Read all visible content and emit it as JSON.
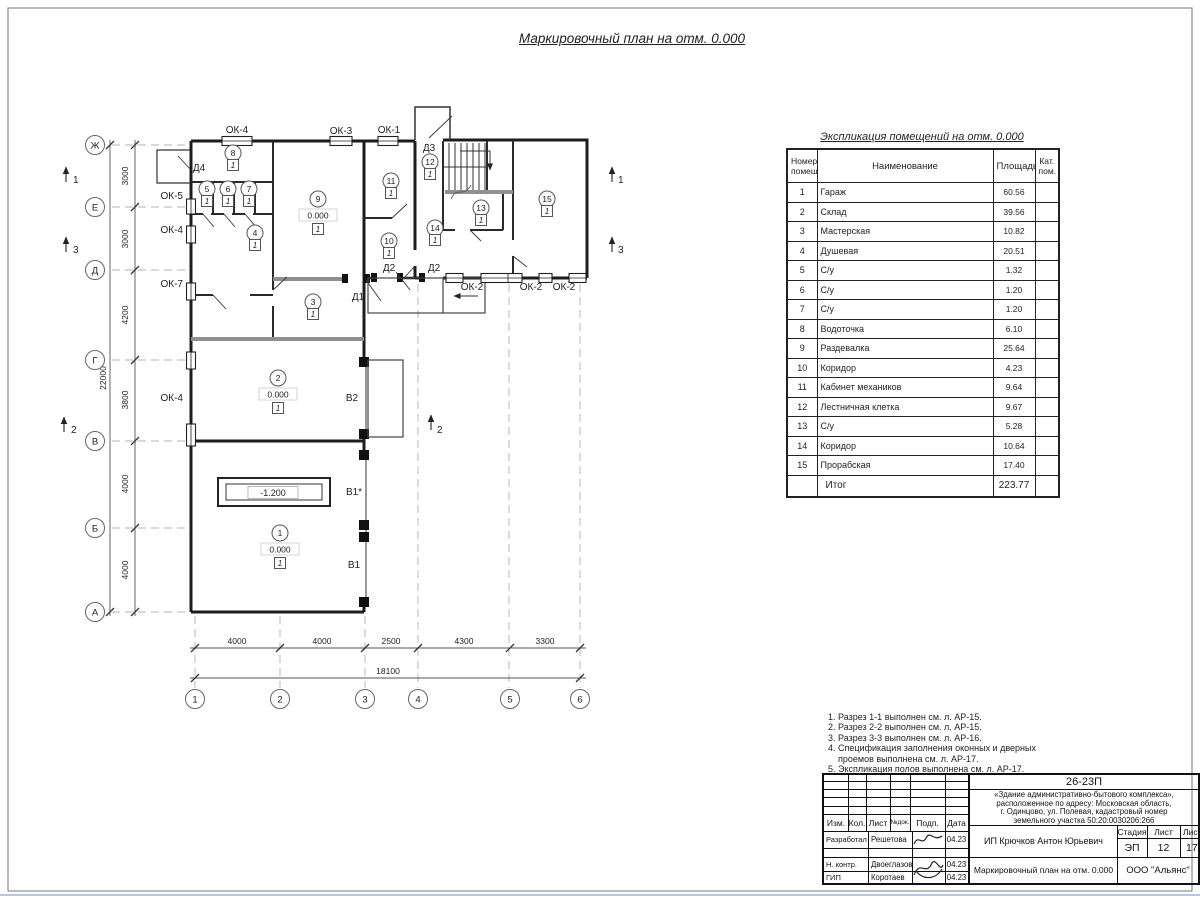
{
  "page": {
    "plan_title": "Маркировочный план на отм. 0.000",
    "schedule_title": "Экспликация помещений на отм. 0.000",
    "notes": "1. Разрез 1-1 выполнен см. л. АР-15.\n2. Разрез 2-2 выполнен см. л. АР-15.\n3. Разрез 3-3 выполнен см. л. АР-16.\n4. Спецификация заполнения оконных и дверных\n    проемов выполнена см. л. АР-17.\n5. Экспликация полов выполнена см. л. АР-17."
  },
  "schedule": {
    "h_num1": "Номер",
    "h_num2": "помещ.",
    "h_name": "Наименование",
    "h_area": "Площадь",
    "h_cat1": "Кат.",
    "h_cat2": "пом.",
    "rows": [
      {
        "n": "1",
        "name": "Гараж",
        "area": "60.56"
      },
      {
        "n": "2",
        "name": "Склад",
        "area": "39.56"
      },
      {
        "n": "3",
        "name": "Мастерская",
        "area": "10.82"
      },
      {
        "n": "4",
        "name": "Душевая",
        "area": "20.51"
      },
      {
        "n": "5",
        "name": "С/у",
        "area": "1.32"
      },
      {
        "n": "6",
        "name": "С/у",
        "area": "1.20"
      },
      {
        "n": "7",
        "name": "С/у",
        "area": "1.20"
      },
      {
        "n": "8",
        "name": "Водоточка",
        "area": "6.10"
      },
      {
        "n": "9",
        "name": "Раздевалка",
        "area": "25.64"
      },
      {
        "n": "10",
        "name": "Коридор",
        "area": "4.23"
      },
      {
        "n": "11",
        "name": "Кабинет механиков",
        "area": "9.64"
      },
      {
        "n": "12",
        "name": "Лестничная клетка",
        "area": "9.67"
      },
      {
        "n": "13",
        "name": "С/у",
        "area": "5.28"
      },
      {
        "n": "14",
        "name": "Коридор",
        "area": "10.64"
      },
      {
        "n": "15",
        "name": "Прорабская",
        "area": "17.40"
      }
    ],
    "total_label": "Итог",
    "total_area": "223.77"
  },
  "axes": {
    "h1": "Ж",
    "h2": "Е",
    "h3": "Д",
    "h4": "Г",
    "h5": "В",
    "h6": "Б",
    "h7": "А",
    "v1": "1",
    "v2": "2",
    "v3": "3",
    "v4": "4",
    "v5": "5",
    "v6": "6"
  },
  "dims": {
    "l1": "3000",
    "l2": "3000",
    "l3": "4200",
    "l4": "3800",
    "l5": "4000",
    "l6": "4000",
    "l_total": "22000",
    "b1": "4000",
    "b2": "4000",
    "b3": "2500",
    "b4": "4300",
    "b5": "3300",
    "b_total": "18100"
  },
  "marks": {
    "ok4_top": "ОК-4",
    "ok3": "ОК-3",
    "ok1": "ОК-1",
    "d3": "Д3",
    "d4": "Д4",
    "ok5": "ОК-5",
    "ok4_left_a": "ОК-4",
    "ok7": "ОК-7",
    "ok4_left_b": "ОК-4",
    "d1": "Д1",
    "d2_a": "Д2",
    "d2_b": "Д2",
    "ok2_a": "ОК-2",
    "ok2_b": "ОК-2",
    "ok2_c": "ОК-2",
    "v2": "В2",
    "v1s": "В1*",
    "v1": "В1",
    "pit": "-1.200",
    "s1": "1",
    "s2": "2",
    "s3": "3"
  },
  "rooms": {
    "r1": {
      "n": "1",
      "elev": "0.000",
      "cat": "1"
    },
    "r2": {
      "n": "2",
      "elev": "0.000",
      "cat": "1"
    },
    "r3": {
      "n": "3",
      "cat": "1"
    },
    "r4": {
      "n": "4",
      "cat": "1"
    },
    "r5": {
      "n": "5",
      "cat": "1"
    },
    "r6": {
      "n": "6",
      "cat": "1"
    },
    "r7": {
      "n": "7",
      "cat": "1"
    },
    "r8": {
      "n": "8",
      "cat": "1"
    },
    "r9": {
      "n": "9",
      "elev": "0.000",
      "cat": "1"
    },
    "r10": {
      "n": "10",
      "cat": "1"
    },
    "r11": {
      "n": "11",
      "cat": "1"
    },
    "r12": {
      "n": "12",
      "cat": "1"
    },
    "r13": {
      "n": "13",
      "cat": "1"
    },
    "r14": {
      "n": "14",
      "cat": "1"
    },
    "r15": {
      "n": "15",
      "cat": "1"
    }
  },
  "titleblock": {
    "code": "26-23П",
    "descr1": "«Здание административно-бытового комплекса»,",
    "descr2": "расположенное по адресу: Московская область,",
    "descr3": "г. Одинцово, ул. Полевая, кадастровый номер",
    "descr4": "земельного участка 50:20:0030206:266",
    "h_izm": "Изм.",
    "h_kol": "Кол.",
    "h_list": "Лист",
    "h_ndok": "№док.",
    "h_podp": "Подп.",
    "h_data": "Дата",
    "r1_role": "Разработал",
    "r1_name": "Решетова",
    "r1_date": "04.23",
    "r2_role": "Н. контр.",
    "r2_name": "Двоеглазов",
    "r2_date": "04.23",
    "r3_role": "ГИП",
    "r3_name": "Коротаев",
    "r3_date": "04.23",
    "client": "ИП Крючков Антон Юрьевич",
    "h_stage": "Стадия",
    "h_sheet": "Лист",
    "h_sheets": "Листов",
    "stage": "ЭП",
    "sheet": "12",
    "sheets": "17",
    "doc_title": "Маркировочный план на отм. 0.000",
    "company": "ООО \"Альянс\""
  }
}
